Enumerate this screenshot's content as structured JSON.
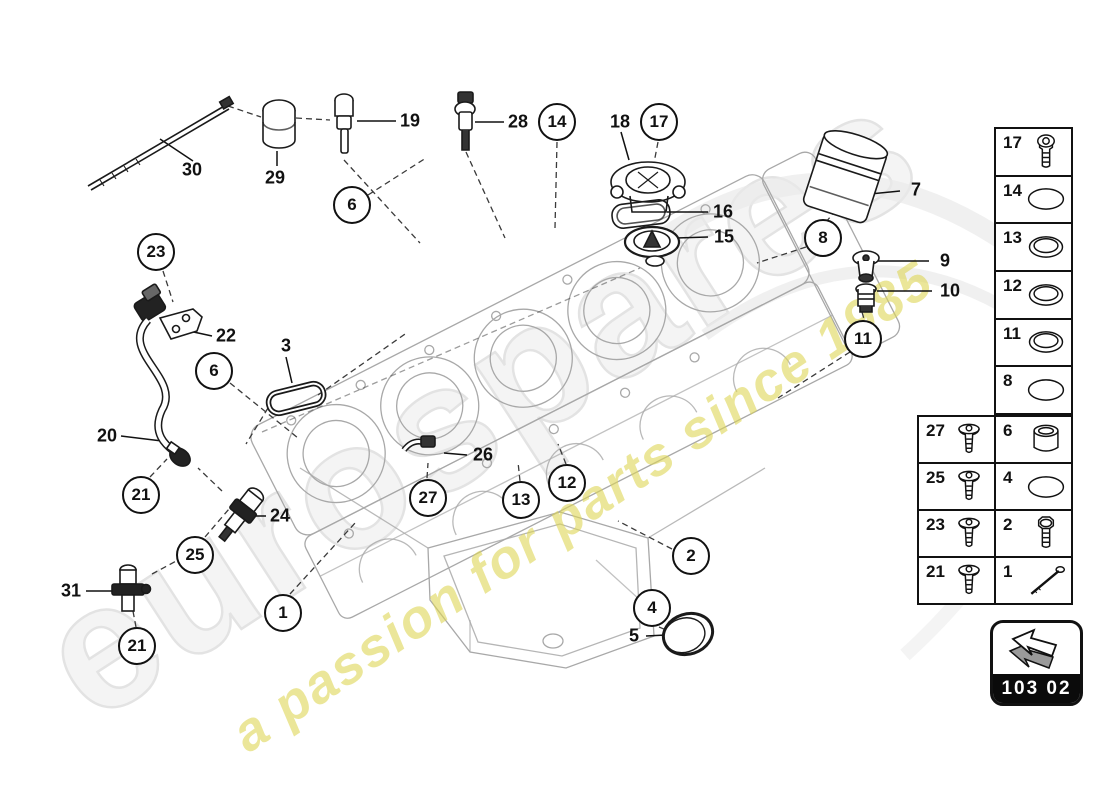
{
  "watermark": {
    "brand": "eurospares",
    "tagline": "a passion for parts since 1985",
    "brand_color": "#f4f4f4",
    "tagline_color": "#ded55a"
  },
  "nav": {
    "code": "103 02"
  },
  "colors": {
    "part_line": "#1a1a1a",
    "engine_line": "#a8a8a8",
    "callout_border": "#111111"
  },
  "diagram": {
    "callouts": [
      {
        "id": "23",
        "x": 156,
        "y": 252
      },
      {
        "id": "6",
        "x": 352,
        "y": 205
      },
      {
        "id": "6",
        "x": 214,
        "y": 371
      },
      {
        "id": "14",
        "x": 557,
        "y": 122
      },
      {
        "id": "17",
        "x": 659,
        "y": 122
      },
      {
        "id": "8",
        "x": 823,
        "y": 238
      },
      {
        "id": "11",
        "x": 863,
        "y": 339
      },
      {
        "id": "21",
        "x": 141,
        "y": 495
      },
      {
        "id": "25",
        "x": 195,
        "y": 555
      },
      {
        "id": "21",
        "x": 137,
        "y": 646
      },
      {
        "id": "1",
        "x": 283,
        "y": 613
      },
      {
        "id": "27",
        "x": 428,
        "y": 498
      },
      {
        "id": "13",
        "x": 521,
        "y": 500
      },
      {
        "id": "12",
        "x": 567,
        "y": 483
      },
      {
        "id": "2",
        "x": 691,
        "y": 556
      },
      {
        "id": "4",
        "x": 652,
        "y": 608
      }
    ],
    "labels": [
      {
        "id": "30",
        "x": 192,
        "y": 170
      },
      {
        "id": "29",
        "x": 275,
        "y": 178
      },
      {
        "id": "19",
        "x": 410,
        "y": 121
      },
      {
        "id": "28",
        "x": 518,
        "y": 122
      },
      {
        "id": "18",
        "x": 620,
        "y": 122
      },
      {
        "id": "16",
        "x": 723,
        "y": 212
      },
      {
        "id": "15",
        "x": 724,
        "y": 237
      },
      {
        "id": "7",
        "x": 916,
        "y": 190
      },
      {
        "id": "9",
        "x": 945,
        "y": 261
      },
      {
        "id": "10",
        "x": 950,
        "y": 291
      },
      {
        "id": "22",
        "x": 226,
        "y": 336
      },
      {
        "id": "3",
        "x": 286,
        "y": 346
      },
      {
        "id": "20",
        "x": 107,
        "y": 436
      },
      {
        "id": "24",
        "x": 280,
        "y": 516
      },
      {
        "id": "26",
        "x": 483,
        "y": 455
      },
      {
        "id": "31",
        "x": 71,
        "y": 591
      },
      {
        "id": "5",
        "x": 634,
        "y": 636
      }
    ]
  },
  "legend": {
    "upper": [
      {
        "num": "17",
        "icon": "socket-bolt"
      },
      {
        "num": "14",
        "icon": "o-ring"
      },
      {
        "num": "13",
        "icon": "seal-ring"
      },
      {
        "num": "12",
        "icon": "seal-ring"
      },
      {
        "num": "11",
        "icon": "seal-ring"
      },
      {
        "num": "8",
        "icon": "o-ring"
      }
    ],
    "lower": [
      [
        {
          "num": "27",
          "icon": "screw"
        },
        {
          "num": "6",
          "icon": "bushing"
        }
      ],
      [
        {
          "num": "25",
          "icon": "screw"
        },
        {
          "num": "4",
          "icon": "o-ring"
        }
      ],
      [
        {
          "num": "23",
          "icon": "screw"
        },
        {
          "num": "2",
          "icon": "hex-bolt"
        }
      ],
      [
        {
          "num": "21",
          "icon": "screw"
        },
        {
          "num": "1",
          "icon": "stud"
        }
      ]
    ]
  }
}
